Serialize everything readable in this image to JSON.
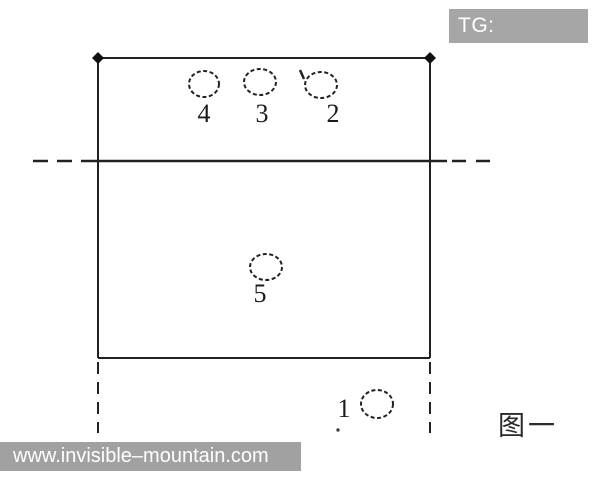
{
  "watermarks": {
    "tg_badge": "TG: MYYJJPP",
    "site": "www.invisible–mountain.com"
  },
  "figure": {
    "caption": "图一",
    "spot_labels": {
      "n1": "1",
      "n2": "2",
      "n3": "3",
      "n4": "4",
      "n5": "5"
    }
  },
  "colors": {
    "badge_bg": "#a6a6a6",
    "footer_bg": "#a1a1a1",
    "line": "#222222",
    "watermark_text": "#ffffff"
  }
}
